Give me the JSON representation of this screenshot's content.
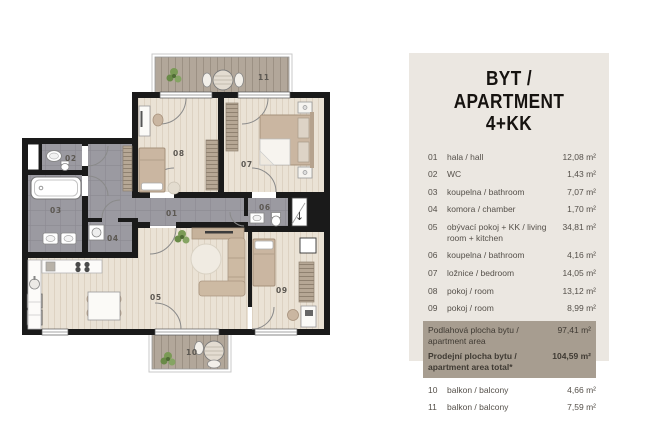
{
  "colors": {
    "panel_bg": "#ebe7e1",
    "highlight_bg": "#a79d90",
    "wall": "#1a1a1a",
    "wood_floor": "#eae2d5",
    "tile_floor": "#9b9aa1",
    "deck_floor": "#b2a79a",
    "furniture_tan": "#cab6a1",
    "text_dark": "#55504a"
  },
  "icons": {
    "entrance_arrow": "↓"
  },
  "plan": {
    "labels": {
      "r01": "01",
      "r02": "02",
      "r03": "03",
      "r04": "04",
      "r05": "05",
      "r06": "06",
      "r07": "07",
      "r08": "08",
      "r09": "09",
      "r10": "10",
      "r11": "11"
    }
  },
  "panel": {
    "title_line1": "BYT / APARTMENT",
    "title_line2": "4+KK",
    "rows": [
      {
        "no": "01",
        "name": "hala / hall",
        "area": "12,08 m²"
      },
      {
        "no": "02",
        "name": "WC",
        "area": "1,43 m²"
      },
      {
        "no": "03",
        "name": "koupelna / bathroom",
        "area": "7,07 m²"
      },
      {
        "no": "04",
        "name": "komora / chamber",
        "area": "1,70 m²"
      },
      {
        "no": "05",
        "name": "obývací pokoj + KK / living room + kitchen",
        "area": "34,81 m²"
      },
      {
        "no": "06",
        "name": "koupelna / bathroom",
        "area": "4,16 m²"
      },
      {
        "no": "07",
        "name": "ložnice / bedroom",
        "area": "14,05 m²"
      },
      {
        "no": "08",
        "name": "pokoj / room",
        "area": "13,12 m²"
      },
      {
        "no": "09",
        "name": "pokoj / room",
        "area": "8,99 m²"
      }
    ],
    "summary_rows": [
      {
        "name": "Podlahová plocha bytu / apartment area",
        "area": "97,41 m²"
      },
      {
        "name": "Prodejní plocha bytu / apartment area total*",
        "area": "104,59 m²"
      }
    ],
    "balcony_rows": [
      {
        "no": "10",
        "name": "balkon / balcony",
        "area": "4,66 m²"
      },
      {
        "no": "11",
        "name": "balkon / balcony",
        "area": "7,59 m²"
      }
    ]
  }
}
